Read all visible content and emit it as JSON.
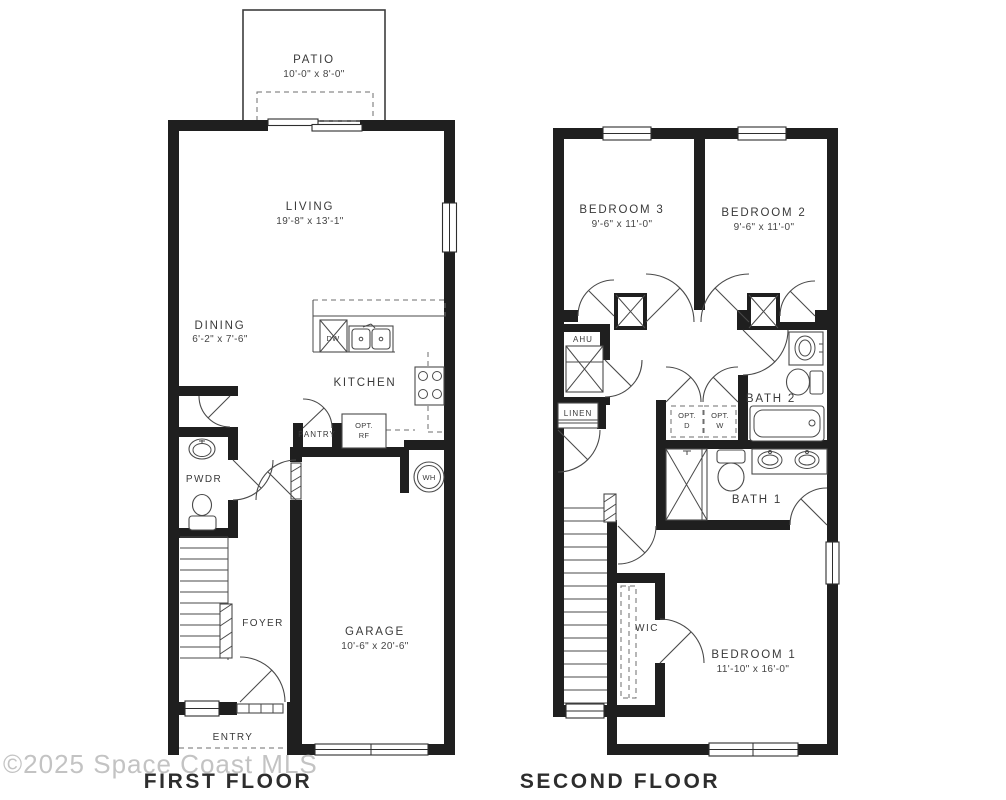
{
  "watermark": "©2025 Space Coast MLS",
  "colors": {
    "wall": "#1f1f1f",
    "line": "#4a4a4a",
    "text": "#3a3a3a",
    "watermark": "#c3c3c3"
  },
  "first_floor": {
    "title": "FIRST FLOOR",
    "patio": {
      "name": "PATIO",
      "dims": "10'-0\" x 8'-0\""
    },
    "living": {
      "name": "LIVING",
      "dims": "19'-8\" x 13'-1\""
    },
    "dining": {
      "name": "DINING",
      "dims": "6'-2\" x 7'-6\""
    },
    "kitchen": {
      "name": "KITCHEN"
    },
    "pantry": {
      "name": "PANTRY"
    },
    "pwdr": {
      "name": "PWDR"
    },
    "foyer": {
      "name": "FOYER"
    },
    "entry": {
      "name": "ENTRY"
    },
    "garage": {
      "name": "GARAGE",
      "dims": "10'-6\" x 20'-6\""
    },
    "fixtures": {
      "dishwasher": "DW",
      "opt_fridge_line1": "OPT.",
      "opt_fridge_line2": "RF",
      "water_heater": "WH"
    }
  },
  "second_floor": {
    "title": "SECOND FLOOR",
    "bedroom3": {
      "name": "BEDROOM 3",
      "dims": "9'-6\" x 11'-0\""
    },
    "bedroom2": {
      "name": "BEDROOM 2",
      "dims": "9'-6\" x 11'-0\""
    },
    "bedroom1": {
      "name": "BEDROOM 1",
      "dims": "11'-10\" x 16'-0\""
    },
    "bath2": {
      "name": "BATH 2"
    },
    "bath1": {
      "name": "BATH 1"
    },
    "wic": {
      "name": "WIC"
    },
    "ahu": {
      "name": "AHU"
    },
    "linen": {
      "name": "LINEN"
    },
    "fixtures": {
      "opt_dryer_line1": "OPT.",
      "opt_dryer_line2": "D",
      "opt_washer_line1": "OPT.",
      "opt_washer_line2": "W"
    }
  }
}
